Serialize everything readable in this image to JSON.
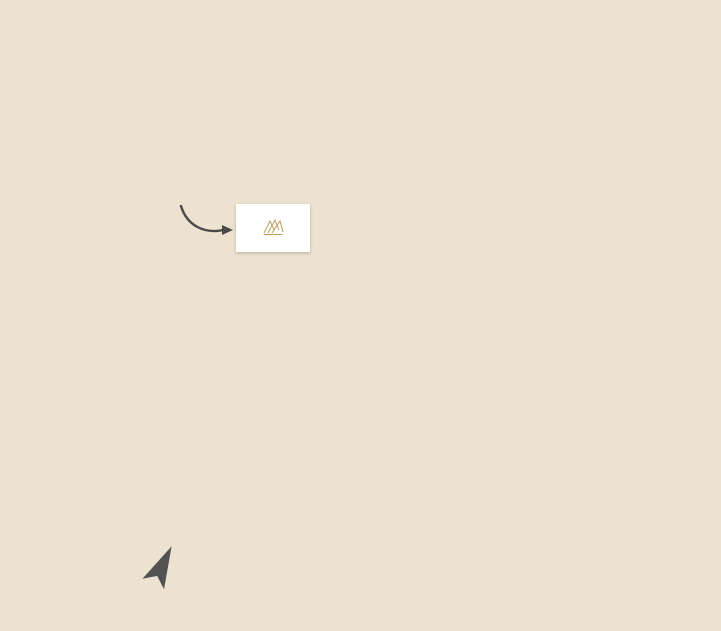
{
  "site_location": {
    "label": "SITE\nLOCATION"
  },
  "logo": {
    "text": "KINGS VILLA"
  },
  "compass": {
    "label": "N"
  },
  "colors": {
    "map_bg": "#ece2cf",
    "road": "#ffffff",
    "water": "#b9d7eb",
    "greenspace": "#ccd2a1",
    "pin_orange": "#f39244",
    "pin_dark": "#4f4c48",
    "pin_red": "#e25a4d",
    "pin_blue": "#93a5d7",
    "pin_lime": "#8cc540",
    "pin_golf": "#6fa87a",
    "accent_gold": "#a5874f"
  },
  "roads": {
    "vertical": [
      {
        "name": "dufferin-street",
        "x": 66,
        "w": 11,
        "y0": 46,
        "y1": 517
      },
      {
        "name": "bathurst-street",
        "x": 227,
        "w": 11,
        "y0": 0,
        "y1": 631
      },
      {
        "name": "yonge-street",
        "x": 391,
        "w": 11,
        "y0": 0,
        "y1": 631
      },
      {
        "name": "bayview-avenue",
        "x": 562,
        "w": 11,
        "y0": 0,
        "y1": 631
      },
      {
        "name": "leslie-street",
        "x": 706,
        "w": 11,
        "y0": 46,
        "y1": 352
      },
      {
        "name": "red-cardinal-trail",
        "x": 314,
        "w": 9,
        "y0": 100,
        "y1": 177
      },
      {
        "name": "minor-street",
        "x": 277,
        "w": 9,
        "y0": 0,
        "y1": 52
      }
    ],
    "horizontal": [
      {
        "name": "15th-sideroad-bloomington",
        "y": 46,
        "h": 11,
        "x0": 0,
        "x1": 721
      },
      {
        "name": "coons-road",
        "y": 97,
        "h": 10,
        "x0": 232,
        "x1": 402
      },
      {
        "name": "humberland-drive",
        "y": 166,
        "h": 10,
        "x0": 232,
        "x1": 402
      },
      {
        "name": "north-lake-road",
        "y": 229,
        "h": 9,
        "x0": 444,
        "x1": 567
      },
      {
        "name": "king-road",
        "y": 282,
        "h": 11,
        "x0": 0,
        "x1": 402
      },
      {
        "name": "king-road-east",
        "y": 283,
        "h": 11,
        "x0": 567,
        "x1": 721
      },
      {
        "name": "king-vaughan-road",
        "y": 505,
        "h": 11,
        "x0": 0,
        "x1": 232
      },
      {
        "name": "east-road",
        "y": 505,
        "h": 11,
        "x0": 562,
        "x1": 721
      },
      {
        "name": "jefferson-sideroad",
        "y": 529,
        "h": 11,
        "x0": 227,
        "x1": 402
      },
      {
        "name": "tower-hill-jefferson-forest",
        "y": 615,
        "h": 11,
        "x0": 227,
        "x1": 573
      }
    ],
    "diagonal": [
      {
        "name": "north-lake-road-diag",
        "cx": 426,
        "cy": 244,
        "len": 56,
        "w": 9,
        "deg": -26
      },
      {
        "name": "old-colony-road-diag",
        "cx": 482,
        "cy": 368,
        "len": 182,
        "w": 9,
        "deg": 20
      }
    ]
  },
  "golf_areas": [
    {
      "name": "bloomington-downs-area-1",
      "x": 558,
      "y": 57,
      "w": 120,
      "h": 73
    },
    {
      "name": "bloomington-downs-area-2",
      "x": 620,
      "y": 100,
      "w": 92,
      "h": 78
    },
    {
      "name": "diamond-back-area",
      "x": 648,
      "y": 175,
      "w": 52,
      "h": 62
    },
    {
      "name": "bathurst-glen-area",
      "x": 238,
      "y": 412,
      "w": 84,
      "h": 57
    },
    {
      "name": "summit-area-1",
      "x": 493,
      "y": 552,
      "w": 80,
      "h": 28
    },
    {
      "name": "summit-area-2",
      "x": 415,
      "y": 578,
      "w": 158,
      "h": 36
    }
  ],
  "lakes": [
    {
      "name": "eversley-lake",
      "label": "EVERSLEY LAKE",
      "fs": 5.5,
      "lx": 121,
      "ly": 14,
      "blobs": [
        {
          "x": 82,
          "y": -10,
          "w": 92,
          "h": 42,
          "rad": "50% 60% 55% 45%",
          "rot": -8
        },
        {
          "x": 93,
          "y": 14,
          "w": 30,
          "h": 32,
          "rad": "40% 60% 50% 60%",
          "rot": 20
        }
      ]
    },
    {
      "name": "wilcox-lake",
      "label": "WILCOX LAKE",
      "fs": 6,
      "lx": 524,
      "ly": 272,
      "blobs": [
        {
          "x": 479,
          "y": 236,
          "w": 94,
          "h": 64,
          "rad": "55% 45% 60% 50%",
          "rot": -6
        },
        {
          "x": 497,
          "y": 284,
          "w": 42,
          "h": 24,
          "rad": "50% 50% 55% 45%",
          "rot": 8
        }
      ]
    },
    {
      "name": "bond-lake",
      "label": "BOND LAKE",
      "fs": 6,
      "lx": 432,
      "ly": 431,
      "blobs": [
        {
          "x": 402,
          "y": 398,
          "w": 34,
          "h": 46,
          "rad": "60% 40% 55% 45%",
          "rot": 18
        },
        {
          "x": 420,
          "y": 388,
          "w": 52,
          "h": 50,
          "rad": "50% 55% 45% 55%",
          "rot": 0
        }
      ]
    },
    {
      "name": "thompson-lake",
      "label": "THOMPSON\nLAKE",
      "fs": 6,
      "lx": 147,
      "ly": 472,
      "blobs": [
        {
          "x": 112,
          "y": 446,
          "w": 72,
          "h": 54,
          "rad": "55% 45% 50% 60%",
          "rot": -12
        }
      ]
    },
    {
      "name": "phillips-lake",
      "label": "PHILLIPS\nLAKE",
      "fs": 6,
      "lx": 288,
      "ly": 497,
      "blobs": [
        {
          "x": 266,
          "y": 470,
          "w": 42,
          "h": 58,
          "rad": "60% 45% 55% 45%",
          "rot": 14
        }
      ]
    }
  ],
  "parks": [
    {
      "name": "briar-nine-park",
      "text": "Briar Nine Park\nand Reserve",
      "x": 328,
      "y": 60,
      "w": 70,
      "h": 31,
      "fs": 5.5
    },
    {
      "name": "russell-tilt-park",
      "text": "Russell Tilt\nPark",
      "x": 345,
      "y": 156,
      "w": 34,
      "h": 22,
      "fs": 5
    },
    {
      "name": "presswood-park",
      "text": "Presswood\nPark",
      "x": 471,
      "y": 196,
      "w": 37,
      "h": 20,
      "fs": 5
    },
    {
      "name": "ozark-park",
      "text": "Ozark\nPark",
      "x": 437,
      "y": 335,
      "w": 26,
      "h": 20,
      "fs": 5
    },
    {
      "name": "samm-park",
      "text": "Samm\nPark",
      "x": 492,
      "y": 337,
      "w": 25,
      "h": 20,
      "fs": 5
    },
    {
      "name": "lake-wilcox-park",
      "text": "Lake\nWilcox\nPark",
      "x": 547,
      "y": 243,
      "w": 24,
      "h": 26,
      "fs": 4.5
    }
  ],
  "road_labels": [
    {
      "name": "label-15th-sideroad",
      "text": "15TH SIDEROAD",
      "x": 25,
      "y": 51,
      "align": "left"
    },
    {
      "name": "label-bloomington",
      "text": "BLOOMINGTON",
      "x": 697,
      "y": 51,
      "align": "left"
    },
    {
      "name": "label-coons-road",
      "text": "COONS ROAD",
      "x": 361,
      "y": 101,
      "align": "center"
    },
    {
      "name": "label-red",
      "text": "RED",
      "x": 299,
      "y": 100,
      "align": "center"
    },
    {
      "name": "label-humberland-drive",
      "text": "HUMBERLAND DRIVE",
      "x": 301,
      "y": 171,
      "align": "center"
    },
    {
      "name": "label-north-lake-road",
      "text": "NORTH LAKE ROAD",
      "x": 505,
      "y": 227,
      "align": "center",
      "fs": 8,
      "ls": 1.5
    },
    {
      "name": "label-king-road",
      "text": "KING ROAD",
      "x": 122,
      "y": 288,
      "align": "center"
    },
    {
      "name": "label-old-colony-road",
      "text": "OLD COLONY ROAD",
      "x": 500,
      "y": 379,
      "align": "center",
      "rot": 20
    },
    {
      "name": "label-king-vaughan-road",
      "text": "KING VAUGHAN ROAD",
      "x": 28,
      "y": 511,
      "align": "left"
    },
    {
      "name": "label-s-ol",
      "text": "S OL",
      "x": 692,
      "y": 511,
      "align": "left"
    },
    {
      "name": "label-jefferson-sideroad",
      "text": "JEFFERSON SIDEROAD",
      "x": 318,
      "y": 534,
      "align": "center"
    },
    {
      "name": "label-tower-hill-road",
      "text": "TOWER HILL ROAD",
      "x": 317,
      "y": 620,
      "align": "center"
    },
    {
      "name": "label-jefferson-forest-drive",
      "text": "JEFFERSON FOREST DRIVE",
      "x": 475,
      "y": 621,
      "align": "center"
    }
  ],
  "street_labels_vertical": [
    {
      "name": "vlabel-dufferin-street",
      "text": "DUFFERIN STREET",
      "x": 67,
      "y": 246
    },
    {
      "name": "vlabel-bathurst-street",
      "text": "BATHURST STREET",
      "x": 228,
      "y": 246
    },
    {
      "name": "vlabel-yonge-street",
      "text": "YONGE STREET",
      "x": 392,
      "y": 260
    },
    {
      "name": "vlabel-bayview-avenue",
      "text": "BAYVIEW AVENUE",
      "x": 564,
      "y": 266
    },
    {
      "name": "vlabel-leslie-street",
      "text": "LESLIE STREET",
      "x": 708,
      "y": 250
    },
    {
      "name": "vlabel-cardinal-trail",
      "text": "CARDINAL TRAIL",
      "x": 306,
      "y": 104,
      "fs": 5.5
    }
  ],
  "free_labels": [
    {
      "name": "label-lago-italian-bakery",
      "text": "Lago Italian Bakery Inc",
      "x": 367,
      "y": 361,
      "align": "right"
    }
  ],
  "route_badges": [
    {
      "num": "40",
      "x": 98,
      "y": 51
    },
    {
      "num": "11",
      "x": 158,
      "y": 288
    },
    {
      "num": "53",
      "x": 73,
      "y": 335
    },
    {
      "num": "38",
      "x": 234,
      "y": 334
    },
    {
      "num": "34",
      "x": 394,
      "y": 333
    },
    {
      "num": "34",
      "x": 566,
      "y": 345
    },
    {
      "num": "12",
      "x": 713,
      "y": 334
    }
  ],
  "pins": [
    {
      "id": "cardinal-carter-high-school",
      "type": "school",
      "x": 247,
      "y": 30,
      "side": "right",
      "label": "Cardinal Carter\nCatholic High School"
    },
    {
      "id": "our-lady-of-hope-elementary",
      "type": "school",
      "x": 296,
      "y": 115,
      "side": "left",
      "label": "Our Lady of Hope\nElementary School"
    },
    {
      "id": "windham-ridge-public-school",
      "type": "school",
      "x": 296,
      "y": 139,
      "side": "left",
      "label": "Windham Ridge\nPublic School"
    },
    {
      "id": "oak-ridges-public-school",
      "type": "school",
      "x": 340,
      "y": 140,
      "side": "above",
      "label": "Oak Ridges\nPublic School"
    },
    {
      "id": "our-lady-of-the-annunciation",
      "type": "school",
      "x": 487,
      "y": 140,
      "side": "above",
      "label": "Our Lady of the Annunciation\nCatholic Elementary School"
    },
    {
      "id": "bond-lake-public-school",
      "type": "school",
      "x": 474,
      "y": 388,
      "side": "right",
      "label": "Bond Lake\nPublic School",
      "fs": 5.5
    },
    {
      "id": "beer-store",
      "type": "cart",
      "x": 411,
      "y": 95,
      "side": "right",
      "label": "Beer\nStore"
    },
    {
      "id": "wild-wing",
      "type": "dining",
      "x": 401,
      "y": 114,
      "side": "right",
      "label": "Wild Wing",
      "fs": 7.5
    },
    {
      "id": "td-bank",
      "type": "bank",
      "x": 413,
      "y": 129,
      "side": "right",
      "label": "TD Bank"
    },
    {
      "id": "sariya-restaurant",
      "type": "dining",
      "x": 399,
      "y": 148,
      "side": "right",
      "label": "Sariya Restaurant"
    },
    {
      "id": "scotia-bank",
      "type": "bank",
      "x": 415,
      "y": 164,
      "side": "right",
      "label": "Scotia\nBank"
    },
    {
      "id": "symposium-cafe",
      "type": "dining",
      "x": 399,
      "y": 180,
      "side": "right",
      "label": "Symposium Cafe Restaurant & Lounge"
    },
    {
      "id": "food-basics",
      "type": "cart",
      "x": 414,
      "y": 197,
      "side": "right",
      "label": "Food\nBasics"
    },
    {
      "id": "rinos-no-frills",
      "type": "cart",
      "x": 411,
      "y": 231,
      "side": "right",
      "label": "Rino's\nNo Frills"
    },
    {
      "id": "canada-post",
      "type": "post",
      "x": 413,
      "y": 269,
      "side": "right",
      "label": "Canada\nPost"
    },
    {
      "id": "posas-snack-bar-plus",
      "type": "dining",
      "x": 547,
      "y": 226,
      "side": "right",
      "label": "Posa's Snack\nBar Plus"
    },
    {
      "id": "sunrise-cafe-and-grill",
      "type": "dining",
      "x": 412,
      "y": 326,
      "side": "right",
      "label": "Sunrise Cafe\nAnd Grill"
    },
    {
      "id": "rbc-royal-bank-north",
      "type": "bank",
      "x": 415,
      "y": 367,
      "side": "right",
      "label": "RBC\nRoyal Bank"
    },
    {
      "id": "oak-ridges-soccer-club",
      "type": "activity",
      "x": 334,
      "y": 316,
      "side": "left",
      "label": "Oak Ridges\nSoccer Club"
    },
    {
      "id": "gourmets-oven-bakery",
      "type": "dining",
      "x": 380,
      "y": 354,
      "side": "left",
      "label": "Gourmet's Oven European\nBakery & Café",
      "dy": -8
    },
    {
      "id": "oak-ridges-community-centre",
      "type": "activity",
      "x": 558,
      "y": 302,
      "side": "left",
      "label": "Oak Ridges\nCommunity\nCentre & Pool",
      "dy": 16
    },
    {
      "id": "lcbo",
      "type": "cart",
      "x": 378,
      "y": 444,
      "side": "left",
      "label": "LCBO"
    },
    {
      "id": "rbc-royal-bank-south",
      "type": "bank",
      "x": 380,
      "y": 470,
      "side": "left",
      "label": "RBC\nRoyal Bank"
    },
    {
      "id": "tangerine-asian-cuisine",
      "type": "dining",
      "x": 380,
      "y": 494,
      "side": "left",
      "label": "Tangerine\nAsian Cuisine"
    },
    {
      "id": "turtle-jacks-muskoka-grill",
      "type": "dining",
      "x": 377,
      "y": 574,
      "side": "left",
      "label": "Turtle Jack's\nMuskoka Grill"
    },
    {
      "id": "td-canada",
      "type": "bank",
      "x": 365,
      "y": 591,
      "side": "left",
      "label": "TD Canada"
    },
    {
      "id": "starbucks",
      "type": "dining",
      "x": 378,
      "y": 606,
      "side": "left",
      "label": "Starbucks"
    },
    {
      "id": "bathurst-glen-golf-course",
      "type": "golf",
      "x": 308,
      "y": 436,
      "side": "left",
      "label": "Bathurst Glen\nGolf Course"
    },
    {
      "id": "summit-golf-club",
      "type": "golf",
      "x": 531,
      "y": 557,
      "side": "left",
      "label": "Summit\nGolf Club"
    },
    {
      "id": "bloomington-downs-golf-course",
      "type": "golf",
      "x": 578,
      "y": 86,
      "side": "right",
      "label": "Bloomington Downs\nGolf Course"
    },
    {
      "id": "diamond-back-golf-club",
      "type": "golf",
      "x": 685,
      "y": 181,
      "side": "left",
      "label": "Diamond Back\nGolf Club"
    }
  ]
}
